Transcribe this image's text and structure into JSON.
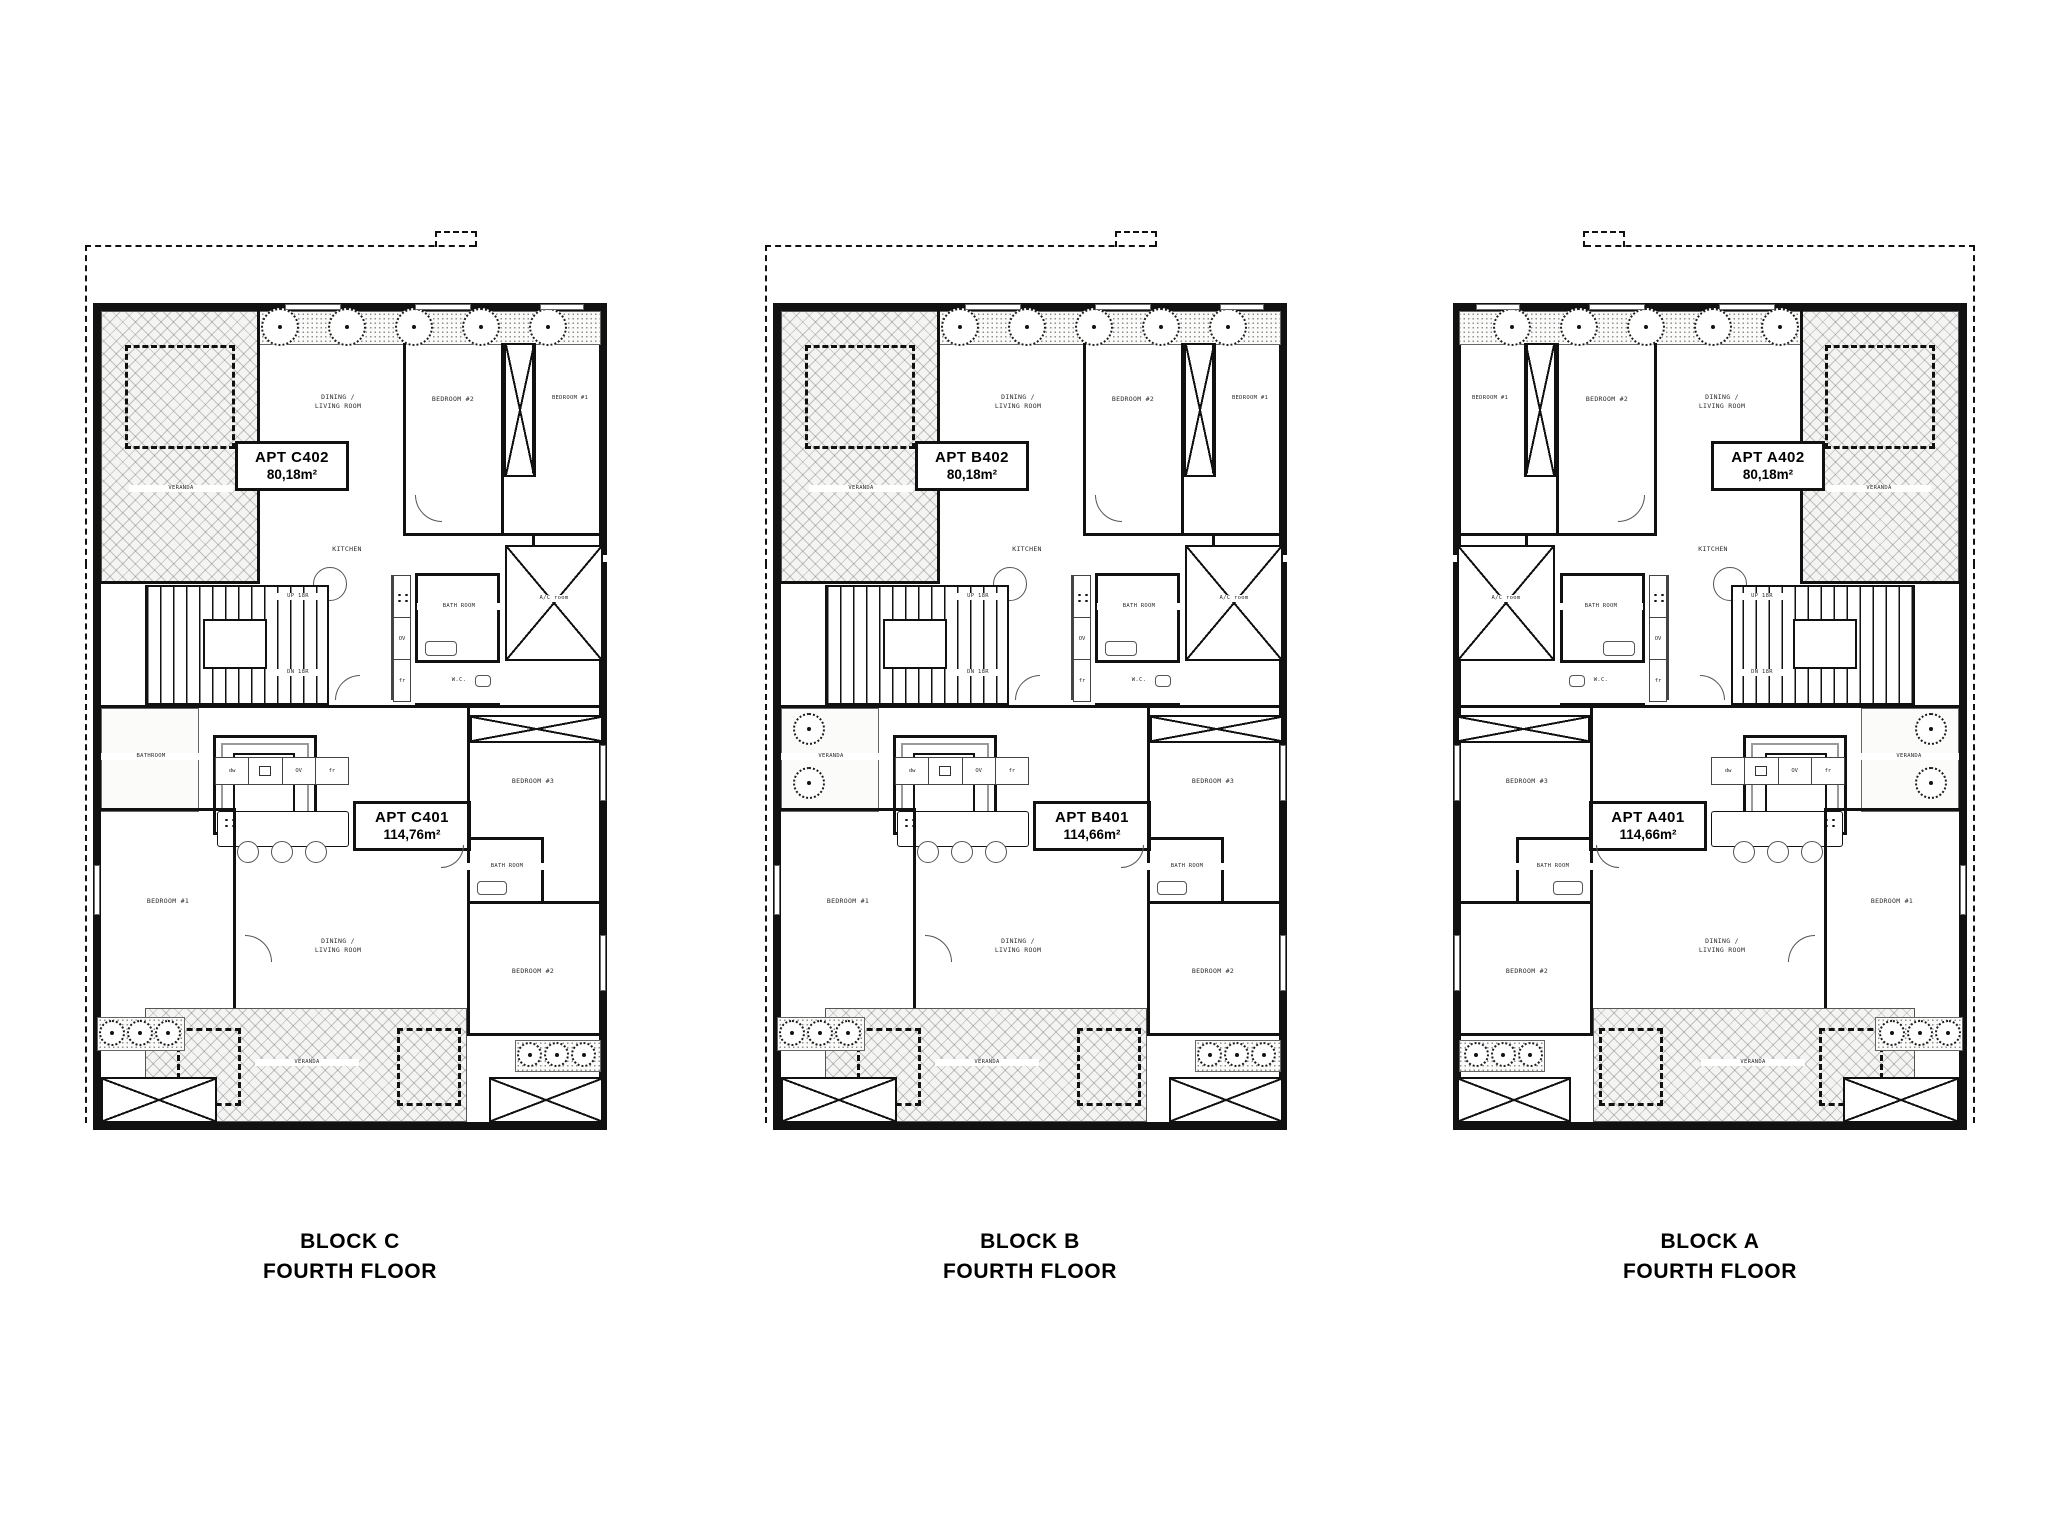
{
  "page": {
    "background": "#ffffff",
    "wall_color": "#111111"
  },
  "blocks": [
    {
      "id": "block-c",
      "mirrored": false,
      "caption": {
        "line1": "BLOCK C",
        "line2": "FOURTH FLOOR"
      },
      "apt_upper": {
        "label": "APT C402",
        "area": "80,18m²"
      },
      "apt_lower": {
        "label": "APT C401",
        "area": "114,76m²"
      },
      "rooms_upper": {
        "veranda": "VERANDA",
        "dining1": "DINING /",
        "dining2": "LIVING ROOM",
        "bedroom2": "BEDROOM #2",
        "bedroom1": "BEDROOM #1",
        "kitchen": "KITCHEN",
        "bath": "BATH ROOM",
        "bath_top": "BATH ROOM"
      },
      "core": {
        "wc": "W.C.",
        "ac": "A/C room",
        "up": "UP 18R",
        "dn": "DN 18R"
      },
      "mid_left": {
        "label": "BATHROOM",
        "hatched": false
      },
      "rooms_lower": {
        "bedroom1": "BEDROOM #1",
        "bedroom2": "BEDROOM #2",
        "bedroom3": "BEDROOM #3",
        "bath": "BATH ROOM",
        "dining1": "DINING /",
        "dining2": "LIVING ROOM",
        "veranda": "VERANDA"
      },
      "appliances": {
        "dw": "dw",
        "ov": "OV",
        "fr": "fr"
      }
    },
    {
      "id": "block-b",
      "mirrored": false,
      "caption": {
        "line1": "BLOCK B",
        "line2": "FOURTH FLOOR"
      },
      "apt_upper": {
        "label": "APT B402",
        "area": "80,18m²"
      },
      "apt_lower": {
        "label": "APT B401",
        "area": "114,66m²"
      },
      "rooms_upper": {
        "veranda": "VERANDA",
        "dining1": "DINING /",
        "dining2": "LIVING ROOM",
        "bedroom2": "BEDROOM #2",
        "bedroom1": "BEDROOM #1",
        "kitchen": "KITCHEN",
        "bath": "BATH ROOM",
        "bath_top": "BATH ROOM"
      },
      "core": {
        "wc": "W.C.",
        "ac": "A/C room",
        "up": "UP 18R",
        "dn": "DN 18R"
      },
      "mid_left": {
        "label": "VERANDA",
        "hatched": true
      },
      "rooms_lower": {
        "bedroom1": "BEDROOM #1",
        "bedroom2": "BEDROOM #2",
        "bedroom3": "BEDROOM #3",
        "bath": "BATH ROOM",
        "dining1": "DINING /",
        "dining2": "LIVING ROOM",
        "veranda": "VERANDA"
      },
      "appliances": {
        "dw": "dw",
        "ov": "OV",
        "fr": "fr"
      }
    },
    {
      "id": "block-a",
      "mirrored": true,
      "caption": {
        "line1": "BLOCK A",
        "line2": "FOURTH FLOOR"
      },
      "apt_upper": {
        "label": "APT A402",
        "area": "80,18m²"
      },
      "apt_lower": {
        "label": "APT A401",
        "area": "114,66m²"
      },
      "rooms_upper": {
        "veranda": "VERANDA",
        "dining1": "DINING /",
        "dining2": "LIVING ROOM",
        "bedroom2": "BEDROOM #2",
        "bedroom1": "BEDROOM #1",
        "kitchen": "KITCHEN",
        "bath": "BATH ROOM",
        "bath_top": "BATH ROOM"
      },
      "core": {
        "wc": "W.C.",
        "ac": "A/C room",
        "up": "UP 18R",
        "dn": "DN 18R"
      },
      "mid_left": {
        "label": "VERANDA",
        "hatched": true
      },
      "rooms_lower": {
        "bedroom1": "BEDROOM #1",
        "bedroom2": "BEDROOM #2",
        "bedroom3": "BEDROOM #3",
        "bath": "BATH ROOM",
        "dining1": "DINING /",
        "dining2": "LIVING ROOM",
        "veranda": "VERANDA"
      },
      "appliances": {
        "dw": "dw",
        "ov": "OV",
        "fr": "fr"
      }
    }
  ]
}
